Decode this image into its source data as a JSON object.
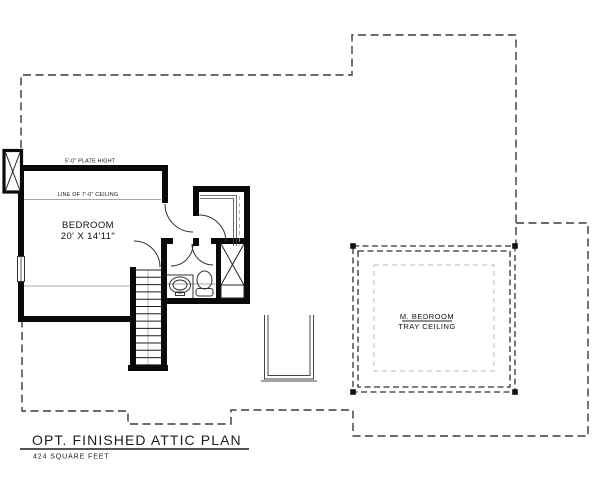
{
  "drawing": {
    "title": "OPT. FINISHED ATTIC PLAN",
    "area_label": "424 SQUARE FEET",
    "rooms": {
      "bedroom": {
        "name": "BEDROOM",
        "dimensions": "20' X 14'11\""
      },
      "master_bedroom": {
        "name": "M. BEDROOM",
        "note": "TRAY CEILING"
      }
    },
    "annotations": {
      "plate_height": "5'-0\" PLATE HIGHT",
      "ceiling_line": "LINE OF 7'-0\" CEILING"
    },
    "colors": {
      "wall": "#0a0a0a",
      "roof_outline": "#3a3a3a",
      "fixture_line": "#333333",
      "tray_dash": "#bbbbbb",
      "ceiling_line": "#a8a8a8",
      "paper": "#ffffff"
    }
  }
}
